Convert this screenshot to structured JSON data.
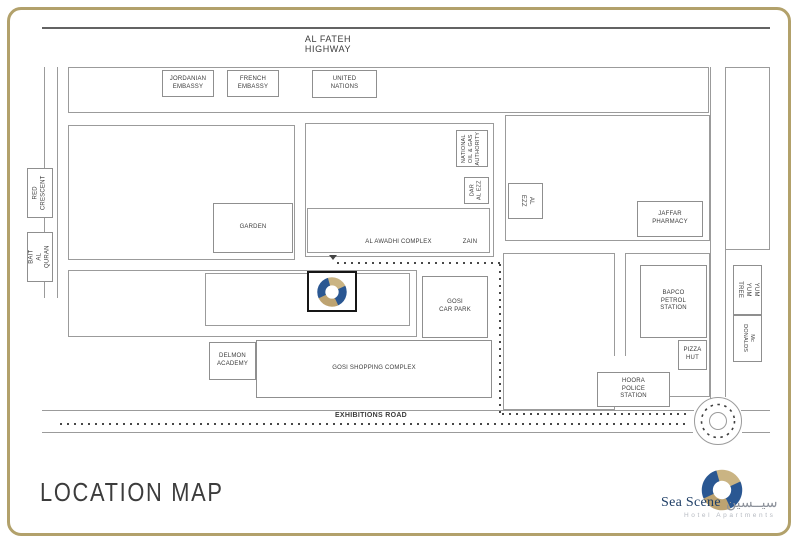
{
  "title": "LOCATION MAP",
  "roads": {
    "highway": "AL FATEH HIGHWAY",
    "exhibitions": "EXHIBITIONS ROAD"
  },
  "places": {
    "jordanian_embassy": "JORDANIAN\nEMBASSY",
    "french_embassy": "FRENCH\nEMBASSY",
    "united_nations": "UNITED\nNATIONS",
    "red_crescent": "RED\nCRESCENT",
    "bait_al_quran": "BAIT\nAL QURAN",
    "garden": "GARDEN",
    "national_oil_gas": "NATIONAL\nOIL & GAS\nAUTHORITY",
    "dar_al_ezz": "DAR\nAL EZZ",
    "al_awadhi_complex": "AL AWADHI COMPLEX",
    "zain": "ZAIN",
    "al_ezz": "AL\nEZZ",
    "jaffar_pharmacy": "JAFFAR\nPHARMACY",
    "yum_yum_tree": "YUM YUM\nTREE",
    "mcdonalds": "Mc DONALDS",
    "gosi_car_park": "GOSI\nCAR PARK",
    "delmon_academy": "DELMON\nACADEMY",
    "gosi_shopping_complex": "GOSI SHOPPING COMPLEX",
    "bapco_petrol_station": "BAPCO\nPETROL\nSTATION",
    "pizza_hut": "PIZZA\nHUT",
    "hoora_police_station": "HOORA\nPOLICE\nSTATION"
  },
  "brand": {
    "name": "Sea Scene",
    "name_arabic": "سيــسين",
    "tagline": "Hotel Apartments"
  },
  "colors": {
    "gold": "#b2a16b",
    "tan": "#cab483",
    "tan_dark": "#bda371",
    "navy": "#2a5792",
    "line": "#9b9b9b",
    "dark_line": "#636363",
    "text": "#3b3b3b",
    "brand_navy": "#1e3e66",
    "brand_gray": "#8d929b",
    "brand_light": "#b6bac1"
  }
}
